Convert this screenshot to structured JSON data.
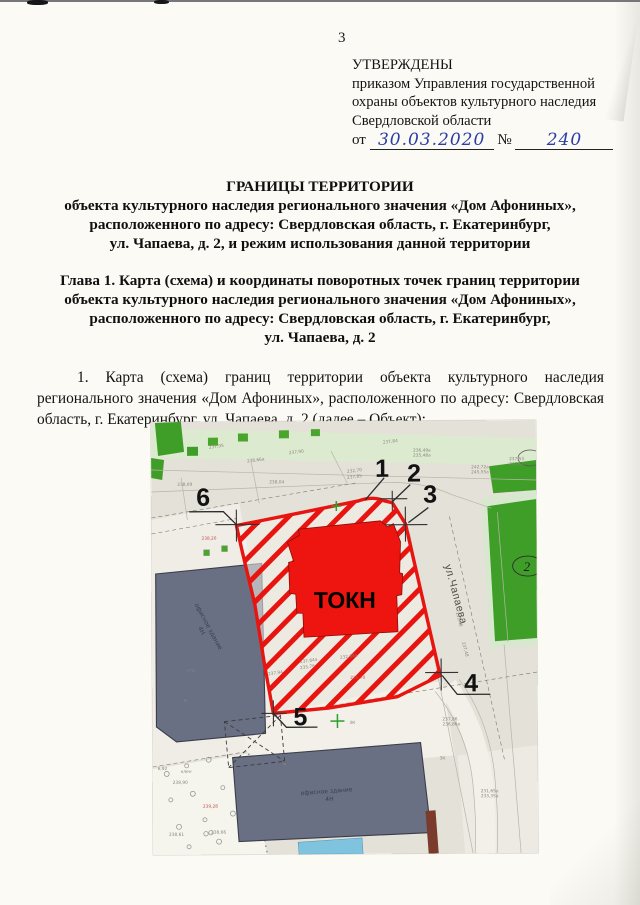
{
  "page": {
    "number": "3"
  },
  "approval": {
    "line1": "УТВЕРЖДЕНЫ",
    "line2": "приказом Управления государственной",
    "line3": "охраны объектов культурного наследия",
    "line4": "Свердловской области",
    "from_label": "от",
    "date_value": "30.03.2020",
    "no_label": "№",
    "no_value": "240"
  },
  "title": {
    "line1": "ГРАНИЦЫ ТЕРРИТОРИИ",
    "line2": "объекта культурного наследия регионального значения «Дом Афониных»,",
    "line3": "расположенного по адресу: Свердловская область, г. Екатеринбург,",
    "line4": "ул. Чапаева, д. 2, и режим использования данной территории"
  },
  "chapter1": {
    "line1": "Глава 1. Карта (схема) и координаты поворотных точек границ территории",
    "line2": "объекта культурного наследия регионального значения «Дом Афониных»,",
    "line3": "расположенного по адресу: Свердловская область, г. Екатеринбург,",
    "line4": "ул. Чапаева, д. 2"
  },
  "paragraph1": "1. Карта (схема) границ территории объекта культурного наследия регионального значения «Дом Афониных», расположенного по адресу: Свердловская область, г. Екатеринбург, ул. Чапаева, д. 2 (далее – Объект):",
  "map": {
    "okn_label": "ТОКН",
    "street_label": "ул.Чапаева",
    "office_building_label": "офисное здание",
    "office_building_floors": "4Н",
    "office_building2_label": "офисное здание",
    "office_building2_floors": "4Н",
    "green_parcel_number": "2",
    "zk_label_1": "ЗК",
    "zk_label_2": "ЗК",
    "tree_label": "клен",
    "point_labels": [
      "1",
      "2",
      "3",
      "4",
      "5",
      "6"
    ],
    "micro_labels": [
      "237,95",
      "238,66а",
      "237,90",
      "232,70",
      "237,85",
      "237,84",
      "236,49а",
      "235,48а",
      "242,72а",
      "245,55а",
      "237,53",
      "237,61",
      "238,09",
      "238,04",
      "238,20",
      "237,64а",
      "235,76",
      "232,64а",
      "237,94",
      "238,90",
      "239,28",
      "238,61",
      "238,66",
      "6,92",
      "231,48",
      "237,48",
      "231,65а",
      "233,35а",
      "237,86",
      "236,86а",
      "235,70",
      "стн",
      "ж",
      "ж"
    ],
    "colors": {
      "territory_red": "#e81410",
      "okn_fill": "#ee1510",
      "building_gray": "#6a7084",
      "green": "#3f9e28",
      "pale_green": "#dcead0",
      "map_bg": "#e4e1d8",
      "paper": "#fbfaf5",
      "handwriting_blue": "#2b3ea6",
      "water_blue": "#7fc3df"
    }
  }
}
